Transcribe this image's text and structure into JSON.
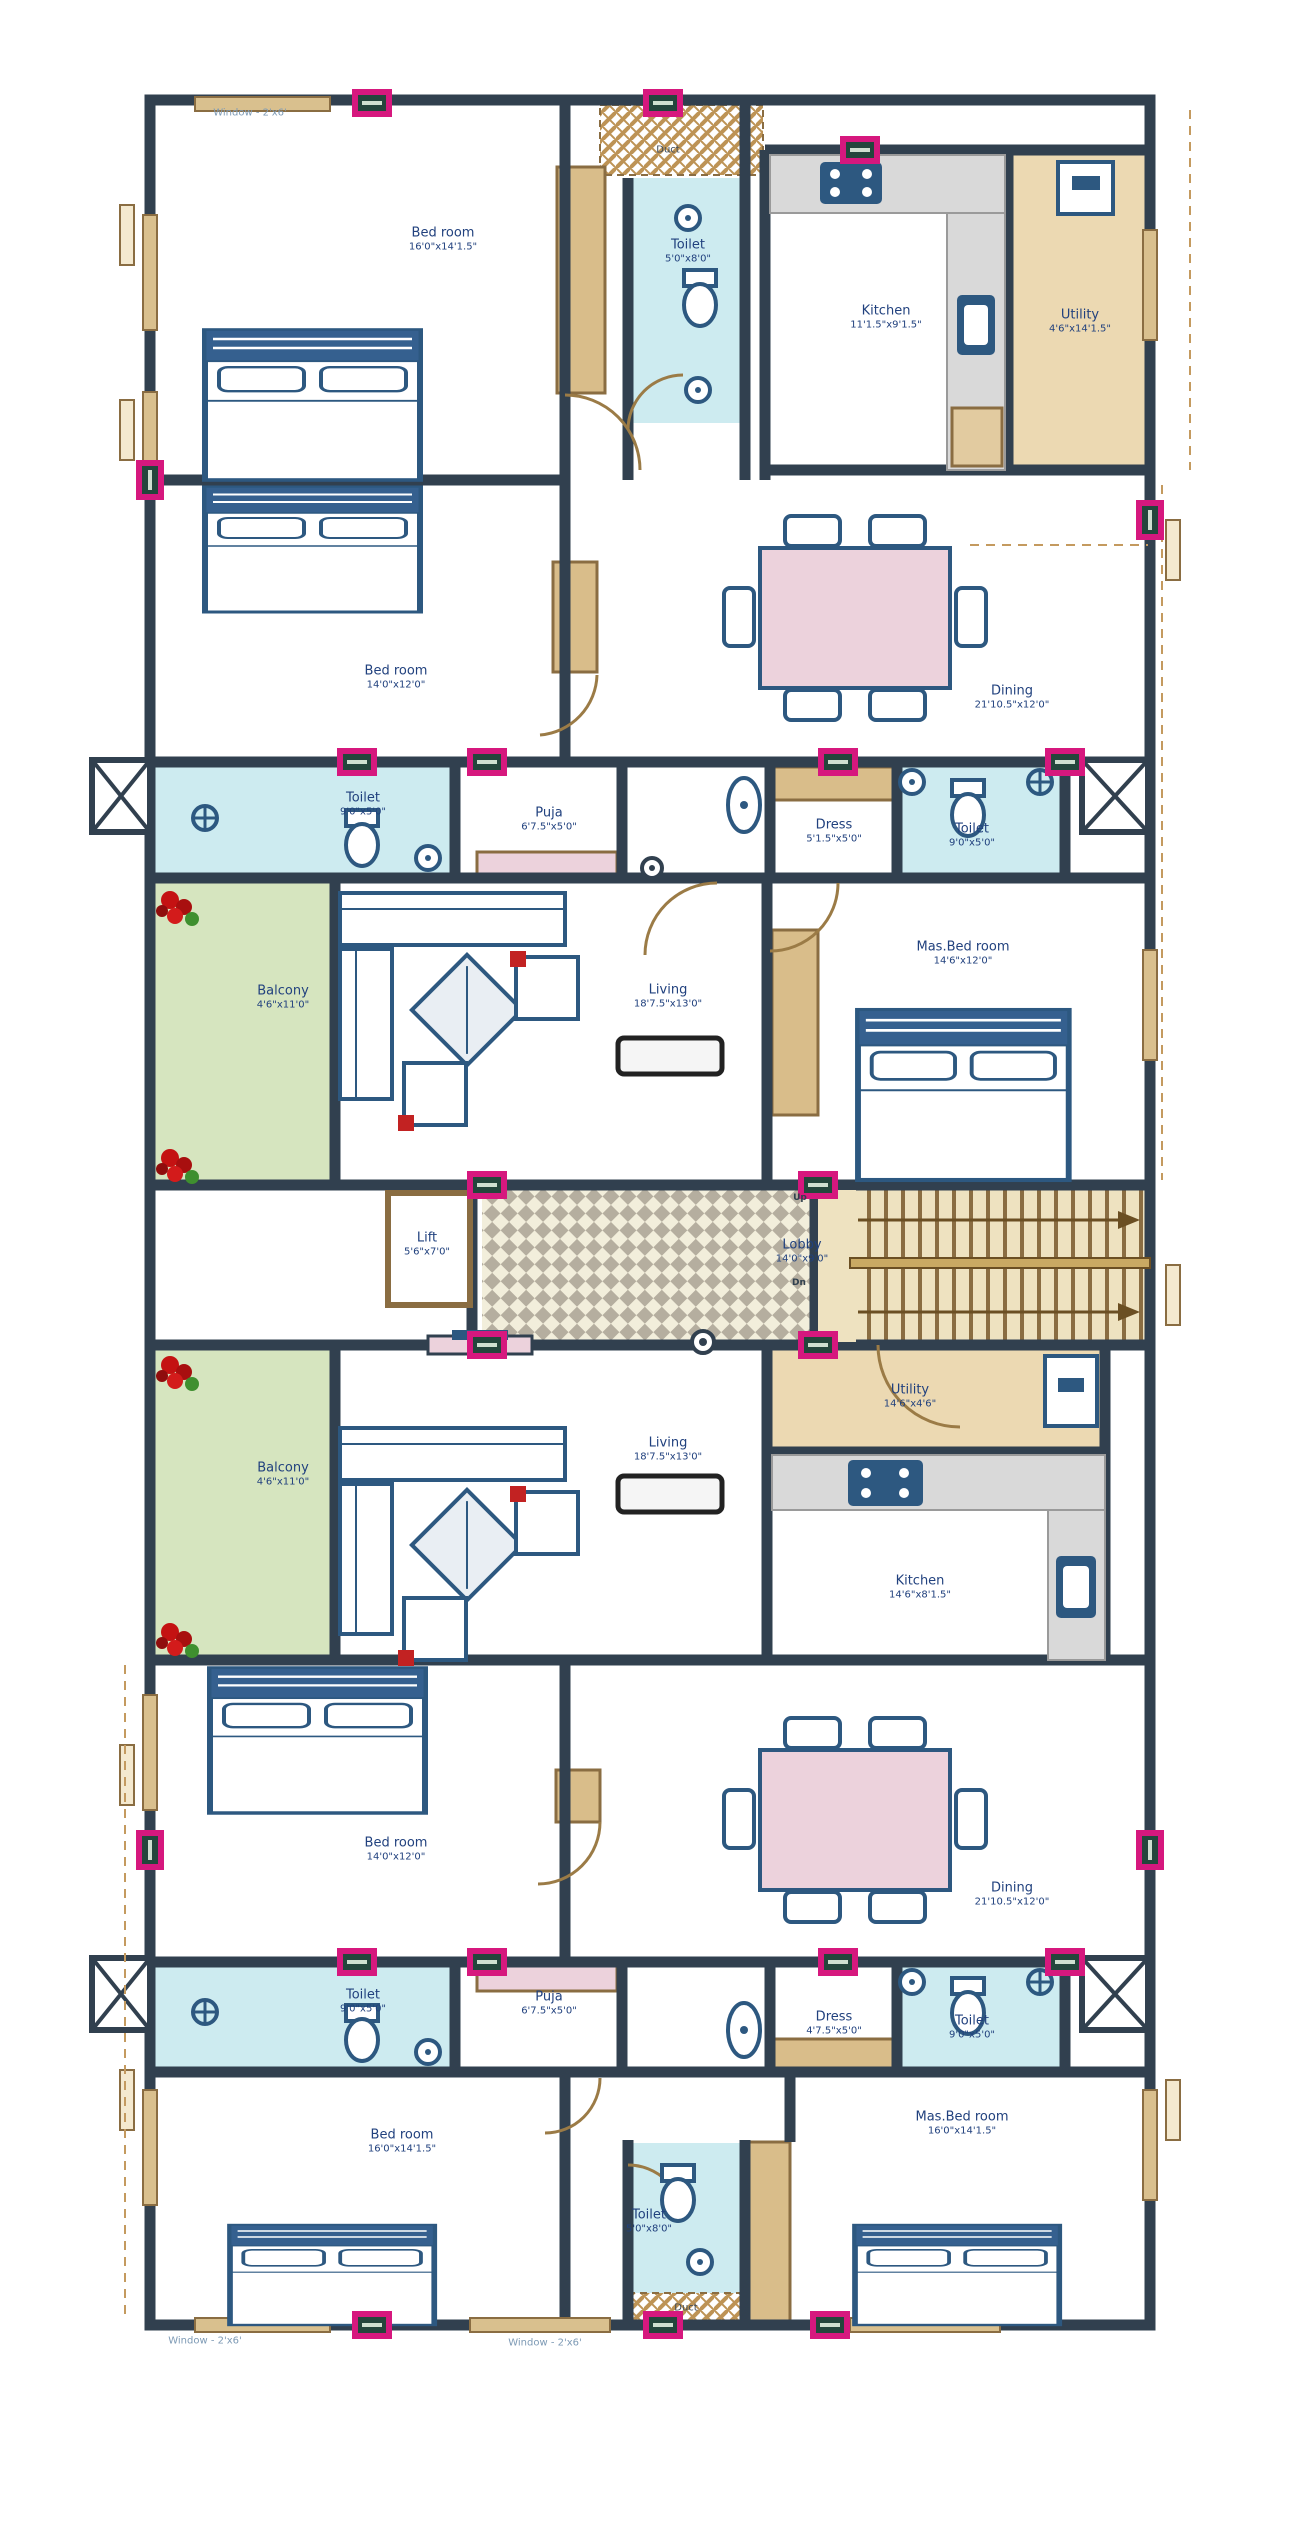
{
  "plan": {
    "title": "Apartment typical floor plan",
    "windows": {
      "top": "Window - 2'x6'",
      "bottom_left": "Window - 2'x6'",
      "bottom_right": "Window - 2'x6'"
    },
    "core": {
      "lift": {
        "name": "Lift",
        "dims": "5'6\"x7'0\""
      },
      "lobby": {
        "name": "Lobby",
        "dims": "14'0\"x9'0\""
      },
      "stairs_up": "Up",
      "stairs_down": "Dn"
    },
    "top_unit": {
      "bedroom_1": {
        "name": "Bed room",
        "dims": "16'0\"x14'1.5\""
      },
      "toilet_attached": {
        "name": "Toilet",
        "dims": "5'0\"x8'0\""
      },
      "kitchen": {
        "name": "Kitchen",
        "dims": "11'1.5\"x9'1.5\""
      },
      "utility": {
        "name": "Utility",
        "dims": "4'6\"x14'1.5\""
      },
      "bedroom_2": {
        "name": "Bed room",
        "dims": "14'0\"x12'0\""
      },
      "dining": {
        "name": "Dining",
        "dims": "21'10.5\"x12'0\""
      },
      "duct": "Duct",
      "toilet_left": {
        "name": "Toilet",
        "dims": "9'0\"x5'0\""
      },
      "puja": {
        "name": "Puja",
        "dims": "6'7.5\"x5'0\""
      },
      "dress": {
        "name": "Dress",
        "dims": "5'1.5\"x5'0\""
      },
      "toilet_right": {
        "name": "Toilet",
        "dims": "9'0\"x5'0\""
      },
      "balcony": {
        "name": "Balcony",
        "dims": "4'6\"x11'0\""
      },
      "living": {
        "name": "Living",
        "dims": "18'7.5\"x13'0\""
      },
      "master": {
        "name": "Mas.Bed room",
        "dims": "14'6\"x12'0\""
      }
    },
    "bottom_unit": {
      "balcony": {
        "name": "Balcony",
        "dims": "4'6\"x11'0\""
      },
      "living": {
        "name": "Living",
        "dims": "18'7.5\"x13'0\""
      },
      "utility": {
        "name": "Utility",
        "dims": "14'6\"x4'6\""
      },
      "kitchen": {
        "name": "Kitchen",
        "dims": "14'6\"x8'1.5\""
      },
      "bedroom_1": {
        "name": "Bed room",
        "dims": "14'0\"x12'0\""
      },
      "dining": {
        "name": "Dining",
        "dims": "21'10.5\"x12'0\""
      },
      "toilet_left": {
        "name": "Toilet",
        "dims": "9'0\"x5'0\""
      },
      "puja": {
        "name": "Puja",
        "dims": "6'7.5\"x5'0\""
      },
      "dress": {
        "name": "Dress",
        "dims": "4'7.5\"x5'0\""
      },
      "toilet_right": {
        "name": "Toilet",
        "dims": "9'0\"x5'0\""
      },
      "bedroom_2": {
        "name": "Bed room",
        "dims": "16'0\"x14'1.5\""
      },
      "master": {
        "name": "Mas.Bed room",
        "dims": "16'0\"x14'1.5\""
      },
      "toilet_attached": {
        "name": "Toilet",
        "dims": "5'0\"x8'0\""
      },
      "duct": "Duct"
    },
    "colors": {
      "wall": "#31404f",
      "furniture": "#2d5880",
      "wood": "#d9bd8a",
      "bathroom": "#cdebf0",
      "balcony": "#d6e5bf",
      "accent_pink": "#ecd2dc",
      "column_marker": "#d6187e",
      "label_text": "#21417e"
    }
  }
}
